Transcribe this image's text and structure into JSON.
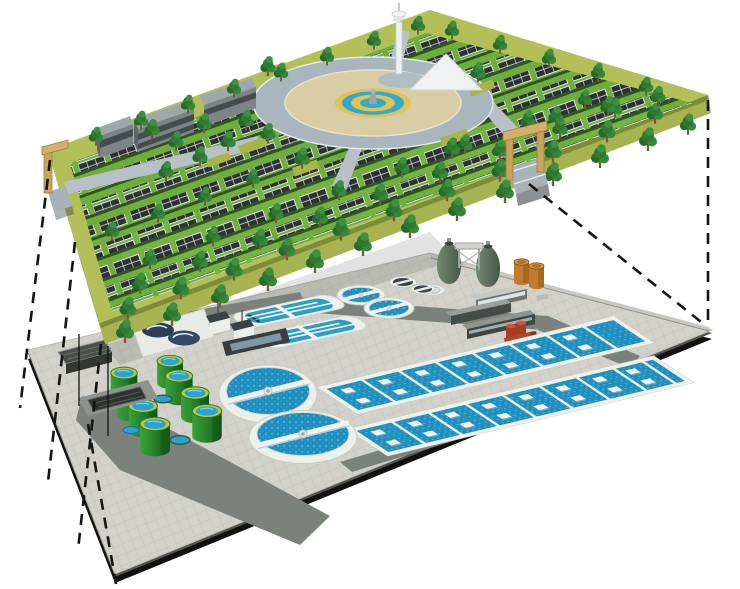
{
  "scene": {
    "title": "Cutaway illustration: rooftop solar park above an underground wastewater treatment plant",
    "type": "3d-architectural-diagram",
    "background": "#ffffff",
    "upper_level": {
      "name": "solar park deck",
      "label": "Elevated landscaped deck with photovoltaic arrays",
      "components": {
        "solar_panel_rows": 8,
        "trees": 73,
        "office_buildings": 3,
        "central_plaza_rings": 6,
        "fountain": 1,
        "observation_tower": 1,
        "entrance_gates": 2,
        "perimeter_path": 1
      }
    },
    "lower_level": {
      "name": "wastewater treatment plant",
      "label": "Underground treatment works on paved slab",
      "components": {
        "green_storage_tanks": 8,
        "circular_clarifiers": 2,
        "oxidation_ditches": 2,
        "round_settling_tanks": 2,
        "dark_thickener_tanks": 2,
        "aeration_basins": 2,
        "egg_digesters": 2,
        "gas_tanks_orange": 2,
        "service_buildings": 3,
        "red_building": 1,
        "headworks_units": 3,
        "access_buildings": 2,
        "roads": 5
      }
    },
    "connections": {
      "dashed_projection_lines_left": 4,
      "dashed_projection_lines_right": 2,
      "access_masts": 2
    },
    "palette": {
      "grass": "#6fae3c",
      "deck_band": "#b3bf58",
      "deck_side": "#9cab48",
      "panel_dark": "#2d3134",
      "panel_grid": "#dfe3e4",
      "tree_green": "#2f7a33",
      "plaza_road": "#a9b6bd",
      "plaza_paving": "#d8cda5",
      "fountain_yellow": "#e0c255",
      "fountain_blue": "#35a9cb",
      "gate_tan": "#c9a55b",
      "slab_tile": "#d2d1ca",
      "road_gray": "#7b827c",
      "edge_black": "#141414",
      "water_blue": "#1f8fc0",
      "tank_green": "#2e8f2f",
      "tank_rim": "#b9cc36",
      "egg_sage": "#5e735f",
      "gas_orange": "#c07c2c",
      "red_building": "#b0452c",
      "dome_navy": "#2b3d57"
    }
  }
}
